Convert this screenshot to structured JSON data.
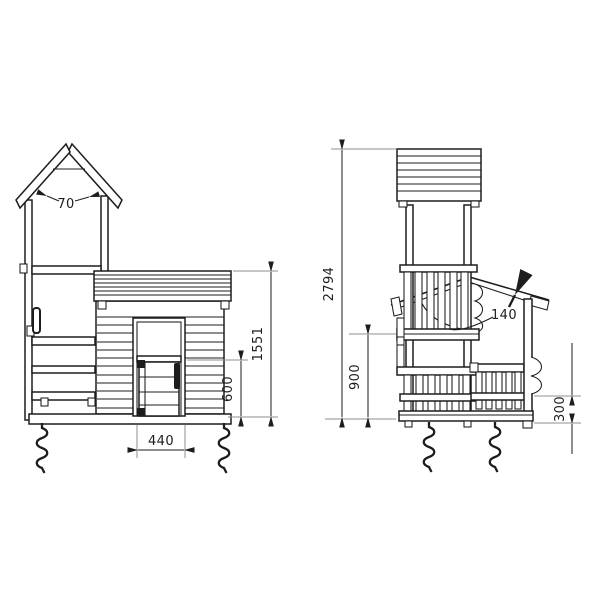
{
  "drawing": {
    "type": "technical-elevation-drawing",
    "subject": "play-tower-with-playhouse",
    "colors": {
      "line": "#1d1d1d",
      "extension_line": "#8f8f8f",
      "background": "#ffffff"
    },
    "dims": {
      "d70": "70",
      "d1551": "1551",
      "d600": "600",
      "d440": "440",
      "d2794": "2794",
      "d900": "900",
      "d140": "140",
      "d300": "300"
    }
  }
}
